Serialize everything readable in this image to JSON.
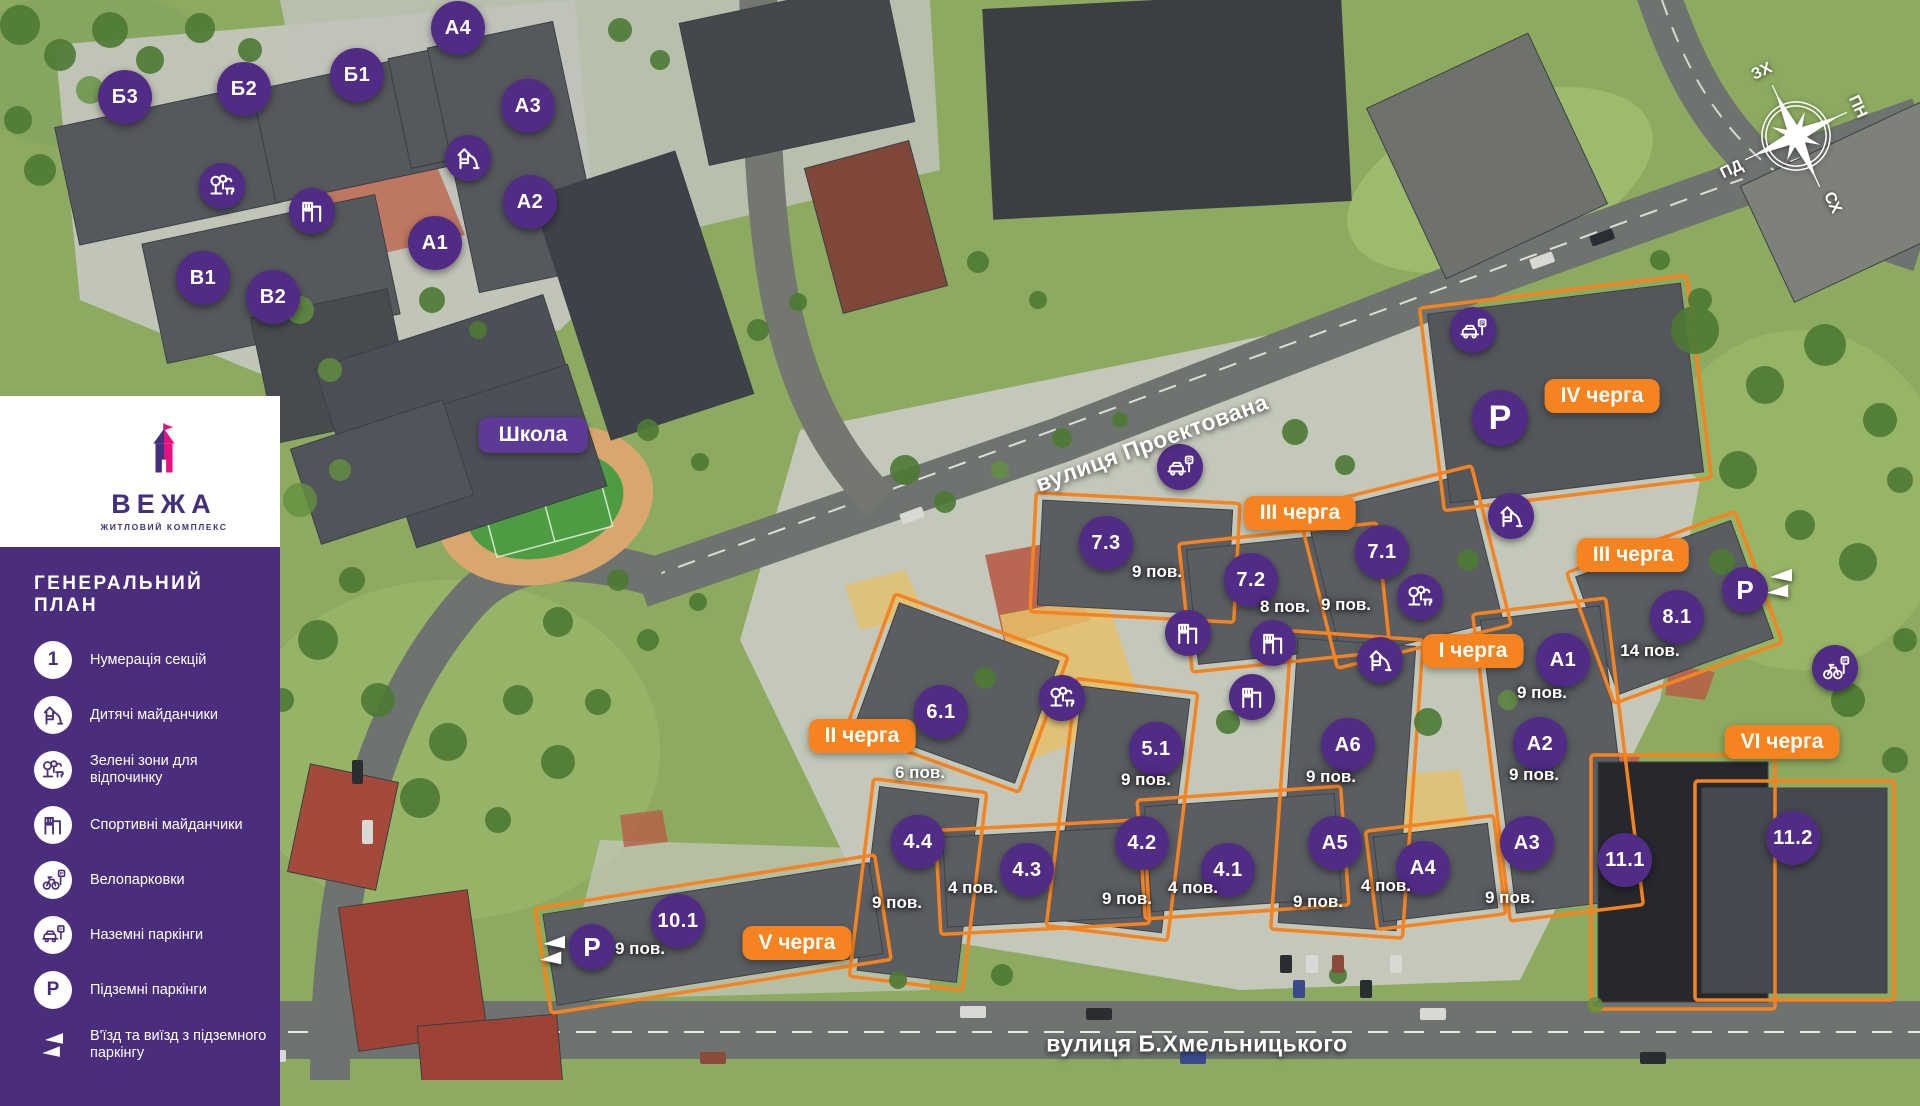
{
  "sidebar": {
    "logo": {
      "name": "ВЕЖА",
      "subtitle": "ЖИТЛОВИЙ КОМПЛЕКС"
    },
    "panel_title": "ГЕНЕРАЛЬНИЙ ПЛАН",
    "legend": [
      {
        "icon": "section-number",
        "glyph": "1",
        "label": "Нумерація секцій"
      },
      {
        "icon": "playground",
        "label": "Дитячі майданчики"
      },
      {
        "icon": "green-zone",
        "label": "Зелені зони для відпочинку"
      },
      {
        "icon": "sport",
        "label": "Спортивні майданчики"
      },
      {
        "icon": "bike-parking",
        "label": "Велопарковки"
      },
      {
        "icon": "surface-parking",
        "label": "Наземні паркінги"
      },
      {
        "icon": "underground-parking",
        "glyph": "P",
        "label": "Підземні паркінги"
      },
      {
        "icon": "entrance",
        "label": "В'їзд та виїзд з підземного паркінгу"
      }
    ]
  },
  "map": {
    "school_label": "Школа",
    "school_pos": {
      "x": 533,
      "y": 435
    },
    "streets": [
      {
        "name": "вулиця Проектована",
        "x": 1152,
        "y": 443,
        "angle": -20
      },
      {
        "name": "вулиця Б.Хмельницького",
        "x": 1197,
        "y": 1044,
        "angle": 0
      }
    ],
    "compass": {
      "x": 1796,
      "y": 136,
      "north": "ПН",
      "east": "СХ",
      "south": "ПД",
      "west": "ЗХ"
    },
    "phases": [
      {
        "label": "I черга",
        "x": 1473,
        "y": 651
      },
      {
        "label": "II черга",
        "x": 862,
        "y": 736
      },
      {
        "label": "III черга",
        "x": 1300,
        "y": 513
      },
      {
        "label": "III черга",
        "x": 1633,
        "y": 555
      },
      {
        "label": "IV черга",
        "x": 1602,
        "y": 396
      },
      {
        "label": "V черга",
        "x": 797,
        "y": 943
      },
      {
        "label": "VI черга",
        "x": 1782,
        "y": 742
      }
    ],
    "sections": [
      {
        "label": "Б3",
        "x": 125,
        "y": 97
      },
      {
        "label": "Б2",
        "x": 244,
        "y": 89
      },
      {
        "label": "Б1",
        "x": 357,
        "y": 75
      },
      {
        "label": "А4",
        "x": 458,
        "y": 28
      },
      {
        "label": "А3",
        "x": 528,
        "y": 106
      },
      {
        "label": "А2",
        "x": 530,
        "y": 202
      },
      {
        "label": "А1",
        "x": 435,
        "y": 243
      },
      {
        "label": "В1",
        "x": 203,
        "y": 278
      },
      {
        "label": "В2",
        "x": 273,
        "y": 297
      },
      {
        "label": "7.3",
        "x": 1106,
        "y": 543,
        "floors": "9 пов.",
        "fx": 1157,
        "fy": 572
      },
      {
        "label": "7.2",
        "x": 1251,
        "y": 580,
        "floors": "8 пов.",
        "fx": 1285,
        "fy": 607
      },
      {
        "label": "7.1",
        "x": 1382,
        "y": 552,
        "floors": "9 пов.",
        "fx": 1346,
        "fy": 605
      },
      {
        "label": "8.1",
        "x": 1677,
        "y": 617,
        "floors": "14 пов.",
        "fx": 1650,
        "fy": 651
      },
      {
        "label": "6.1",
        "x": 941,
        "y": 712,
        "floors": "6 пов.",
        "fx": 920,
        "fy": 773
      },
      {
        "label": "5.1",
        "x": 1156,
        "y": 749,
        "floors": "9 пов.",
        "fx": 1146,
        "fy": 780
      },
      {
        "label": "А6",
        "x": 1348,
        "y": 745,
        "floors": "9 пов.",
        "fx": 1331,
        "fy": 777
      },
      {
        "label": "А1",
        "x": 1563,
        "y": 660,
        "floors": "9 пов.",
        "fx": 1542,
        "fy": 693
      },
      {
        "label": "А2",
        "x": 1540,
        "y": 744,
        "floors": "9 пов.",
        "fx": 1534,
        "fy": 775
      },
      {
        "label": "4.4",
        "x": 918,
        "y": 842,
        "floors": "9 пов.",
        "fx": 897,
        "fy": 903
      },
      {
        "label": "4.3",
        "x": 1027,
        "y": 870,
        "floors": "4 пов.",
        "fx": 973,
        "fy": 888
      },
      {
        "label": "4.2",
        "x": 1142,
        "y": 843,
        "floors": "9 пов.",
        "fx": 1127,
        "fy": 899
      },
      {
        "label": "4.1",
        "x": 1228,
        "y": 870,
        "floors": "4 пов.",
        "fx": 1193,
        "fy": 888
      },
      {
        "label": "А5",
        "x": 1335,
        "y": 843,
        "floors": "9 пов.",
        "fx": 1318,
        "fy": 902
      },
      {
        "label": "А4",
        "x": 1423,
        "y": 868,
        "floors": "4 пов.",
        "fx": 1386,
        "fy": 886
      },
      {
        "label": "А3",
        "x": 1527,
        "y": 843,
        "floors": "9 пов.",
        "fx": 1510,
        "fy": 898
      },
      {
        "label": "11.1",
        "x": 1625,
        "y": 860
      },
      {
        "label": "11.2",
        "x": 1793,
        "y": 838
      },
      {
        "label": "10.1",
        "x": 678,
        "y": 921,
        "floors": "9 пов.",
        "fx": 640,
        "fy": 949
      }
    ],
    "icons": [
      {
        "type": "playground",
        "x": 468,
        "y": 158
      },
      {
        "type": "playground",
        "x": 1380,
        "y": 660
      },
      {
        "type": "playground",
        "x": 1511,
        "y": 516
      },
      {
        "type": "sport",
        "x": 312,
        "y": 211
      },
      {
        "type": "sport",
        "x": 1188,
        "y": 633
      },
      {
        "type": "sport",
        "x": 1273,
        "y": 643
      },
      {
        "type": "sport",
        "x": 1252,
        "y": 697
      },
      {
        "type": "green-zone",
        "x": 222,
        "y": 186
      },
      {
        "type": "green-zone",
        "x": 1062,
        "y": 698
      },
      {
        "type": "green-zone",
        "x": 1420,
        "y": 597
      },
      {
        "type": "bike-parking",
        "x": 1835,
        "y": 668
      },
      {
        "type": "surface-parking",
        "x": 1180,
        "y": 467
      },
      {
        "type": "surface-parking",
        "x": 1473,
        "y": 330
      },
      {
        "type": "underground-parking",
        "glyph": "P",
        "x": 1500,
        "y": 418,
        "size": "lg"
      },
      {
        "type": "underground-parking",
        "glyph": "P",
        "x": 1745,
        "y": 590
      },
      {
        "type": "underground-parking",
        "glyph": "P",
        "x": 592,
        "y": 947
      },
      {
        "type": "entrance",
        "x": 1780,
        "y": 583
      },
      {
        "type": "entrance",
        "x": 553,
        "y": 950
      }
    ]
  },
  "colors": {
    "brand_purple": "#4a2d7c",
    "marker_purple": "#512c87",
    "accent_orange": "#f5831f",
    "logo_pink": "#e6117e"
  }
}
